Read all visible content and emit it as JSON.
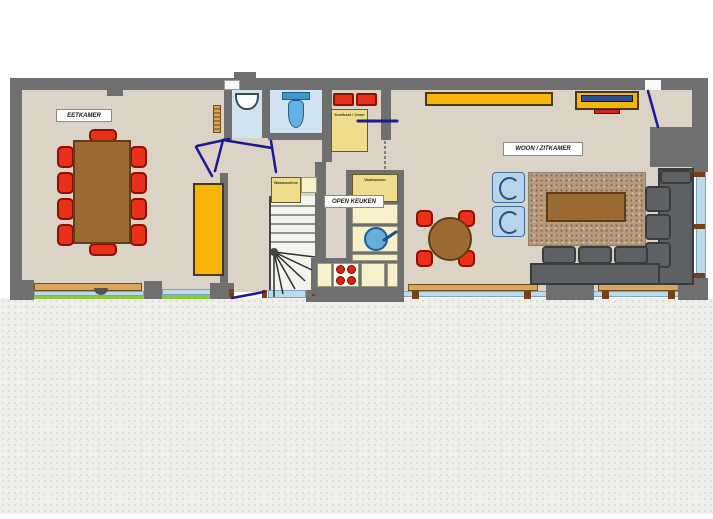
{
  "floorplan": {
    "rooms": {
      "dining_label": "EETKAMER",
      "kitchen_label": "OPEN KEUKEN",
      "living_label": "WOON / ZITKAMER"
    },
    "appliances": {
      "fridge_oven_label": "Koelkast / Oven",
      "washer_label": "Wasmachine",
      "dishwasher_label": "Vaatwasser"
    },
    "colors": {
      "wall": "#6f6f6f",
      "floor": "#dbd3c5",
      "furniture_yellow": "#f7b40a",
      "unit_yellow": "#eedc8f",
      "counter_cream": "#f7f0ca",
      "chair_red": "#e8301a",
      "wood_brown": "#9c6b33",
      "rug_brown": "#b59a7e",
      "sofa_gray": "#5d6164",
      "wetroom_blue": "#cfe3f0",
      "toilet_blue": "#63b1e0",
      "window_blue": "#b9dcec",
      "grass_green": "#8cc63e",
      "door_blue": "#1a1a99",
      "sill_tan": "#d8a75c",
      "ground_gray": "#efefec"
    }
  }
}
